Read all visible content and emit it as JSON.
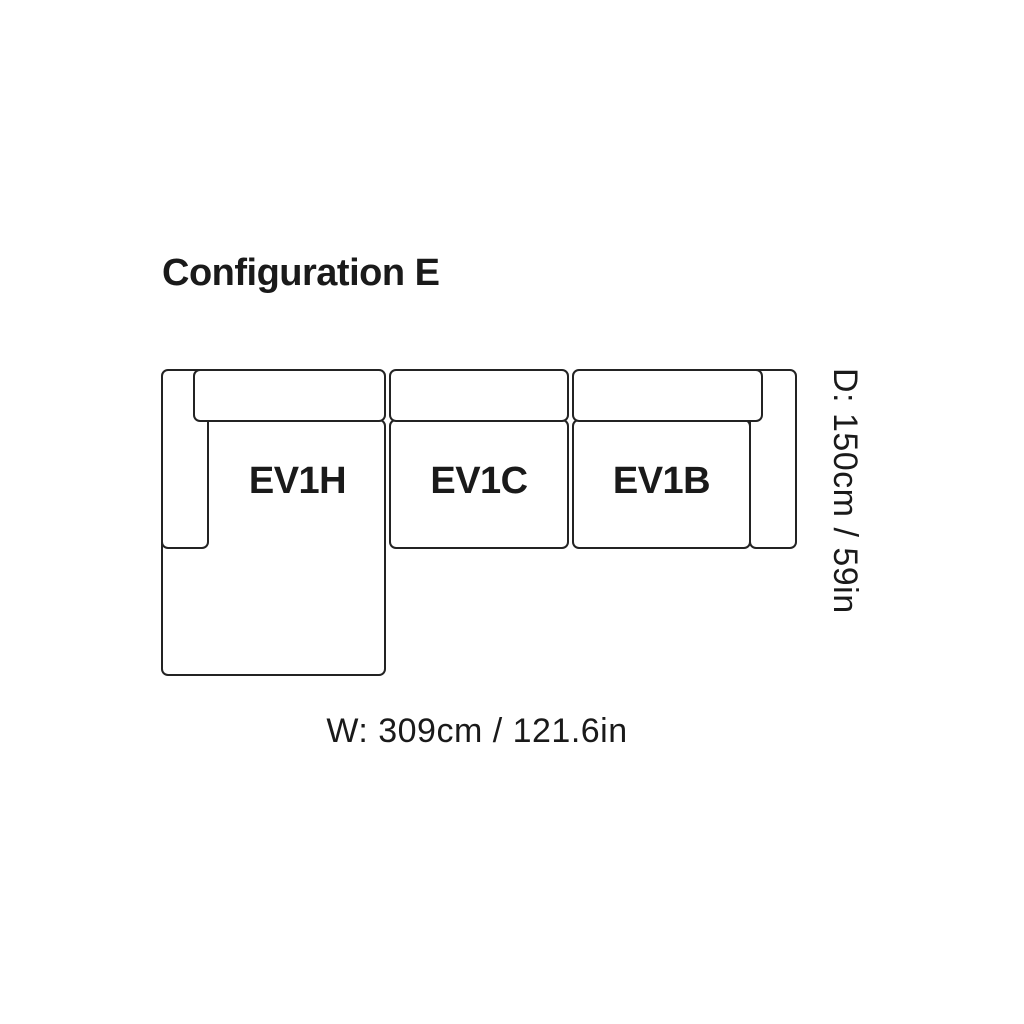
{
  "title": "Configuration E",
  "colors": {
    "stroke": "#232323",
    "text": "#1a1a1a",
    "background": "#ffffff"
  },
  "diagram": {
    "type": "sofa-configuration-top-view",
    "modules": [
      {
        "label": "EV1H",
        "position": "left-chaise"
      },
      {
        "label": "EV1C",
        "position": "center"
      },
      {
        "label": "EV1B",
        "position": "right-arm"
      }
    ],
    "dimensions": {
      "width_label": "W: 309cm / 121.6in",
      "depth_label": "D: 150cm / 59in"
    }
  }
}
